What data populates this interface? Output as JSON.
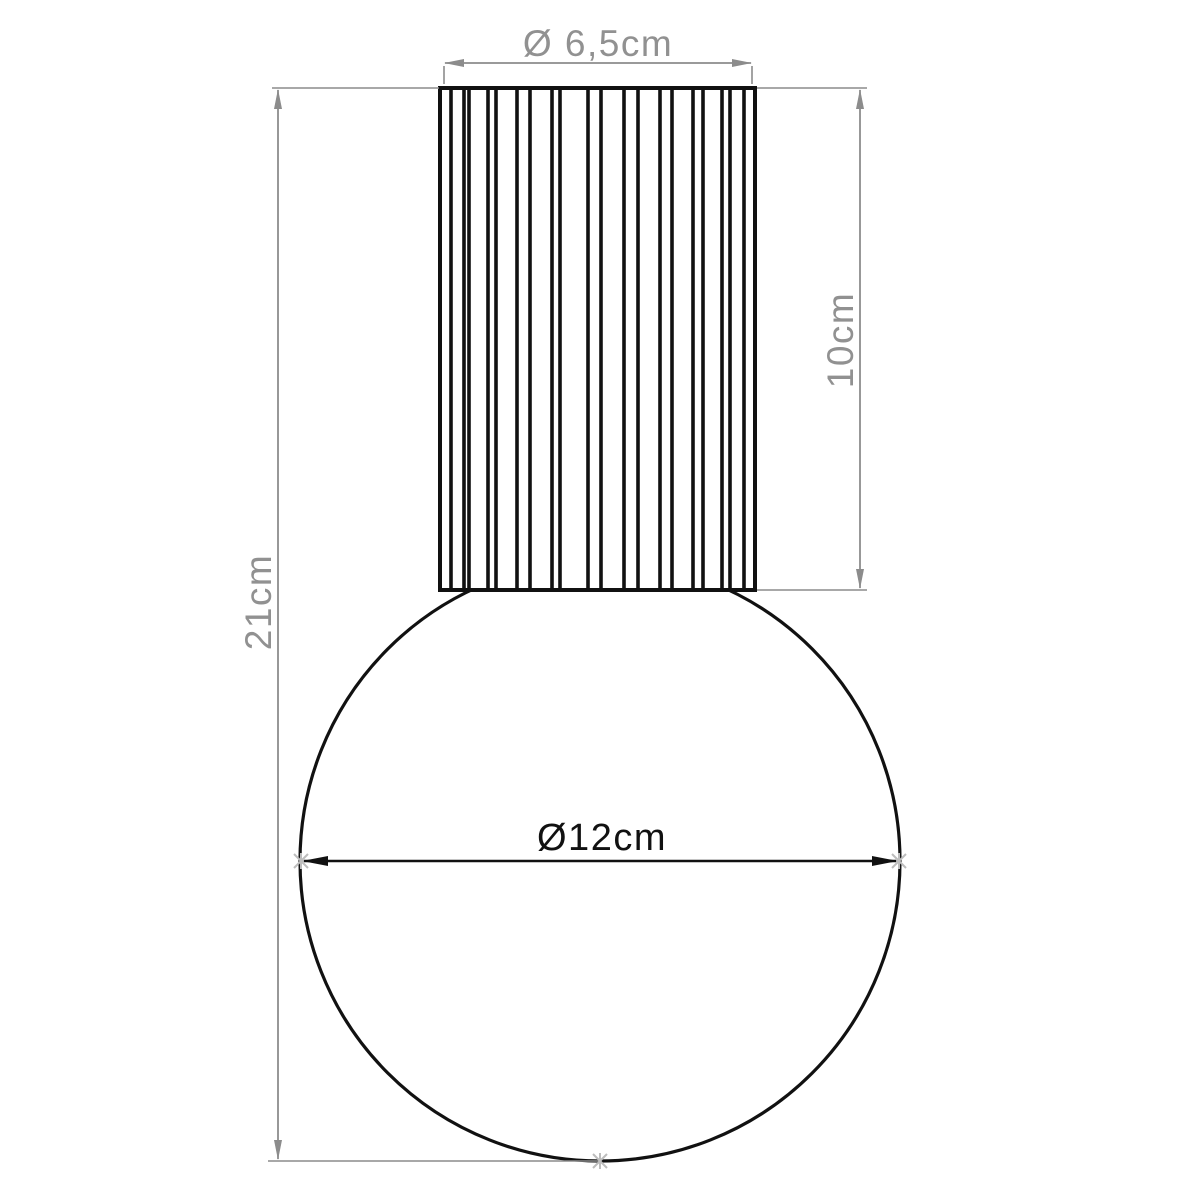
{
  "drawing": {
    "description": "Technical dimension drawing of a lamp: fluted cylindrical fitting above a spherical globe shade",
    "colors": {
      "outline": "#111111",
      "dimension": "#8c8c8c",
      "dimension_text": "#919191",
      "marker": "#bdbdbd",
      "background": "#ffffff"
    },
    "dimensions": {
      "shade_diameter": {
        "label": "Ø 6,5cm",
        "value_cm": 6.5
      },
      "shade_height": {
        "label": "10cm",
        "value_cm": 10
      },
      "total_height": {
        "label": "21cm",
        "value_cm": 21
      },
      "globe_diameter": {
        "label": "Ø12cm",
        "value_cm": 12
      }
    },
    "shade_rib_lines_x": [
      440,
      451,
      464,
      469,
      488,
      496,
      517,
      530,
      552,
      560,
      588,
      601,
      624,
      638,
      660,
      672,
      693,
      703,
      722,
      730,
      744,
      755
    ]
  }
}
